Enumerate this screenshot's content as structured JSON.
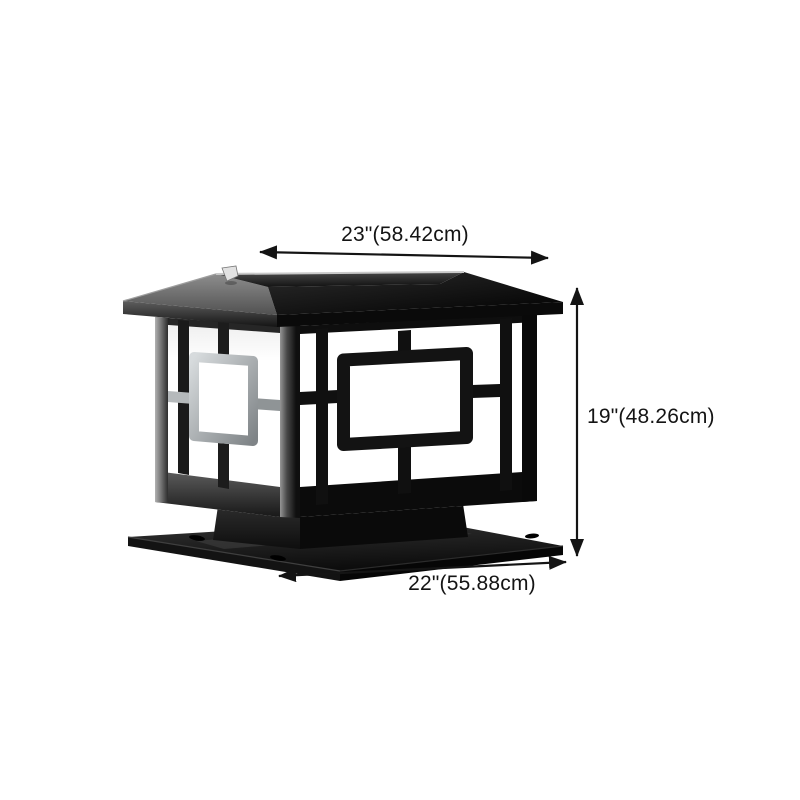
{
  "scene": {
    "type": "product-dimension-diagram",
    "product_name": "Black square solar post cap lantern",
    "background_color": "#ffffff",
    "annotation_color": "#141414"
  },
  "dimensions": {
    "top_width": "23\"(58.42cm)",
    "height": "19\"(48.26cm)",
    "base_width": "22\"(55.88cm)"
  },
  "lantern_colors": {
    "frame_black": "#0d0d0d",
    "lit_gray": "#b7bbbd",
    "roof_gray": "#6f6f6f",
    "diffuser_white": "#ffffff",
    "solar_panel": "#2b2b2b",
    "accent_silver": "#d9d9d9"
  }
}
